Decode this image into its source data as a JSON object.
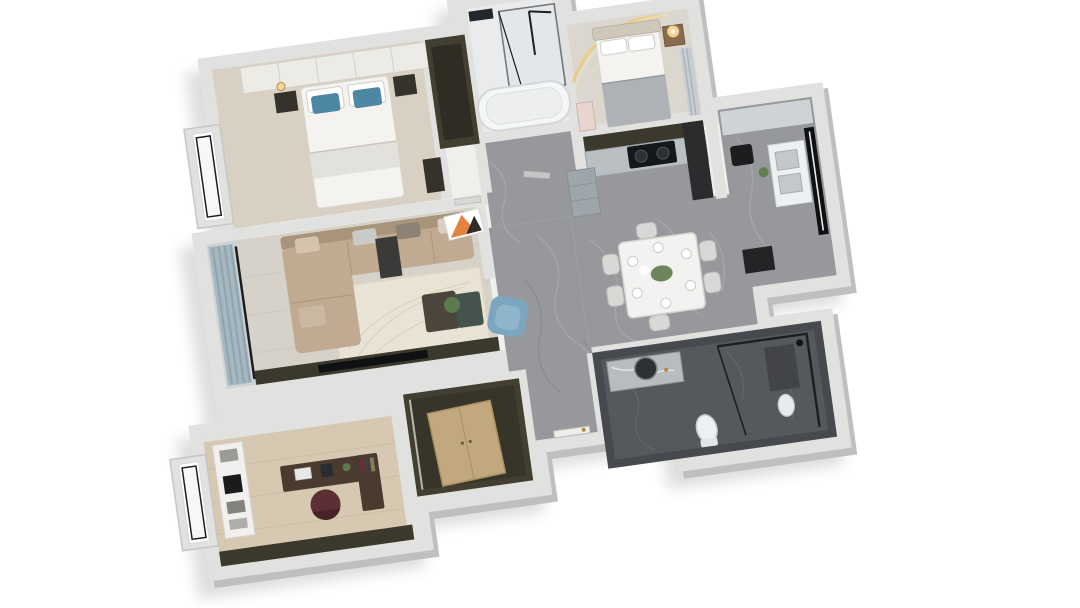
{
  "meta": {
    "title": "3D apartment floor plan rendering",
    "view": "top-down axonometric dollhouse render, tilted about 8 degrees",
    "background": "#ffffff",
    "no_visible_text": true
  },
  "colors": {
    "wall": "#e1e1e0",
    "wallSide": "#bfbfbe",
    "shadow": "#000000",
    "marble": "#96989c",
    "marbleVeinLight": "#aaacb0",
    "marbleVeinDark": "#7e8084",
    "livingFloor": "#d7d2c9",
    "bedroomFloor": "#d9d0c4",
    "bedroom2Floor": "#dcd7ce",
    "officeFloor": "#d6c8b1",
    "bath1Floor": "#e9ebec",
    "bath2Wall": "#46494d",
    "bath2Floor": "#55585c",
    "darkOlive": "#3b392c",
    "closetDark": "#433f30",
    "cabinetGray": "#a4abb0",
    "counterLight": "#ced3d5",
    "sofaTan": "#c0ab92",
    "sofaBack": "#a8937b",
    "rug": "#e9e3d6",
    "armchairBlue": "#7aa6bf",
    "pillowBlue": "#4c88a4",
    "woodCabinet": "#c2a87e",
    "woodDesk": "#4a3b31",
    "deskChair": "#5d2e34",
    "bedWhite": "#f4f3f0",
    "blanketGray": "#aeb2b7",
    "headboardWood": "#cfc8ba",
    "nightstandDark": "#34322b",
    "nightstandWood": "#8a6c4c",
    "lampGlow": "#f6d89b",
    "arcLight": "#e9cb83",
    "curtainBlue": "#a5b7c0",
    "curtainStripe": "#8fa3ad",
    "artOrange": "#e2833f",
    "plantGreen": "#5d7a4a",
    "glassFrame": "#1c1e20",
    "white": "#ffffff",
    "tableWhite": "#f2f2f0",
    "chairGray": "#d8d8d6"
  },
  "rooms": [
    {
      "id": "master-bedroom",
      "name": "Master bedroom",
      "position": "top-left",
      "floor": "light beige",
      "furniture": [
        "double bed with blue pillows",
        "wardrobe wall",
        "dark nightstands",
        "bay window",
        "tall dark wardrobe"
      ]
    },
    {
      "id": "bathroom-1",
      "name": "Bathroom 1",
      "position": "top-middle",
      "floor": "light tile",
      "furniture": [
        "glass shower",
        "bathtub",
        "black fixtures"
      ]
    },
    {
      "id": "hall-nook",
      "name": "Hall nook",
      "position": "below bathroom 1",
      "floor": "marble",
      "furniture": [
        "interior door"
      ]
    },
    {
      "id": "second-bedroom",
      "name": "Second bedroom",
      "position": "top-right",
      "floor": "light beige",
      "furniture": [
        "bed with gray blanket",
        "wood nightstand with glowing lamp",
        "arched LED wall light",
        "striped curtains",
        "pink shelf"
      ]
    },
    {
      "id": "kitchen",
      "name": "Kitchen",
      "position": "right of hall",
      "floor": "marble",
      "furniture": [
        "dark upper cabinets",
        "gray base cabinets",
        "black cooktop",
        "tall dark unit"
      ]
    },
    {
      "id": "utility-balcony",
      "name": "Utility balcony",
      "position": "far right",
      "floor": "marble",
      "furniture": [
        "tall black window",
        "counter with double sink",
        "small dark appliance",
        "plant"
      ]
    },
    {
      "id": "dining-area",
      "name": "Dining area",
      "position": "center-right",
      "floor": "gray marble",
      "furniture": [
        "white dining table",
        "six chairs",
        "place settings",
        "green centerpiece",
        "gray cabinet unit"
      ]
    },
    {
      "id": "living-room",
      "name": "Living room",
      "position": "center-left",
      "floor": "light wood",
      "furniture": [
        "L-shaped tan sofa",
        "cream rug",
        "two-tone coffee table with plant",
        "blue armchair",
        "dark TV wall",
        "orange artwork"
      ]
    },
    {
      "id": "living-balcony",
      "name": "Living balcony",
      "position": "left",
      "floor": "gray",
      "furniture": [
        "blue-gray striped curtains",
        "glass door frame"
      ]
    },
    {
      "id": "study",
      "name": "Study",
      "position": "bottom-left",
      "floor": "wood",
      "furniture": [
        "white bookshelf with TV",
        "dark wood desk",
        "dark red office chair",
        "bay window",
        "dark accent wall"
      ]
    },
    {
      "id": "closet-room",
      "name": "Closet room",
      "position": "bottom-middle",
      "floor": "dark olive",
      "furniture": [
        "tan wood cabinet"
      ]
    },
    {
      "id": "entry",
      "name": "Entry",
      "position": "bottom-center",
      "floor": "marble",
      "furniture": [
        "front door with gold handle"
      ]
    },
    {
      "id": "bathroom-2",
      "name": "Bathroom 2",
      "position": "bottom-right",
      "floor": "dark gray",
      "furniture": [
        "marble vanity with round mirror",
        "toilet",
        "glass shower"
      ]
    }
  ]
}
